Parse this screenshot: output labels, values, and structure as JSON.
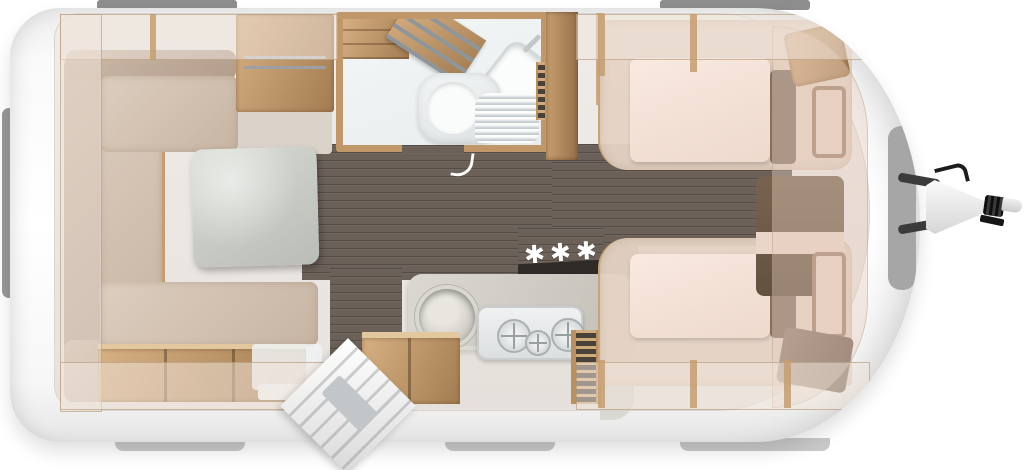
{
  "scene": {
    "type": "caravan floor plan, top-down cutaway render",
    "heating_marker": "✱✱✱"
  },
  "palette": {
    "background": "#ffffff",
    "shell_white": "#f7f7f7",
    "roof_window_gray": "#8d8d8d",
    "skirt_gray": "#c9c9c9",
    "front_window_gray": "#a6a6a6",
    "floor_dark_wood": "#6b6159",
    "furniture_wood": "#c49d72",
    "furniture_wood_dark": "#85613d",
    "upholstery_beige": "#d5c5b5",
    "mattress_cream": "#f6e4da",
    "pink_cabinet_front": "#e9d3c7",
    "table_gray": "#c9cdc7",
    "worktop_gray": "#cfcdc5",
    "sanitary_white": "#eff2f3",
    "hob_cover_black": "#2e2b28",
    "hitch_black": "#1c1c1c"
  },
  "objects": {
    "lounge": [
      "L-shaped seating",
      "pedestal table",
      "overhead lockers",
      "bench storage boxes"
    ],
    "midship": [
      "wardrobe with hanging rail",
      "washroom with toilet, washbasin and shower tray",
      "tall cabinet",
      "kitchen with round sink and 3-burner hob",
      "open entrance door"
    ],
    "bedroom": [
      "twin single beds",
      "bedside chest",
      "front wardrobe cabinets",
      "overhead lockers"
    ],
    "exterior": [
      "roof/side windows",
      "drawbar with coupling hitch and handbrake",
      "heating position marker"
    ]
  }
}
